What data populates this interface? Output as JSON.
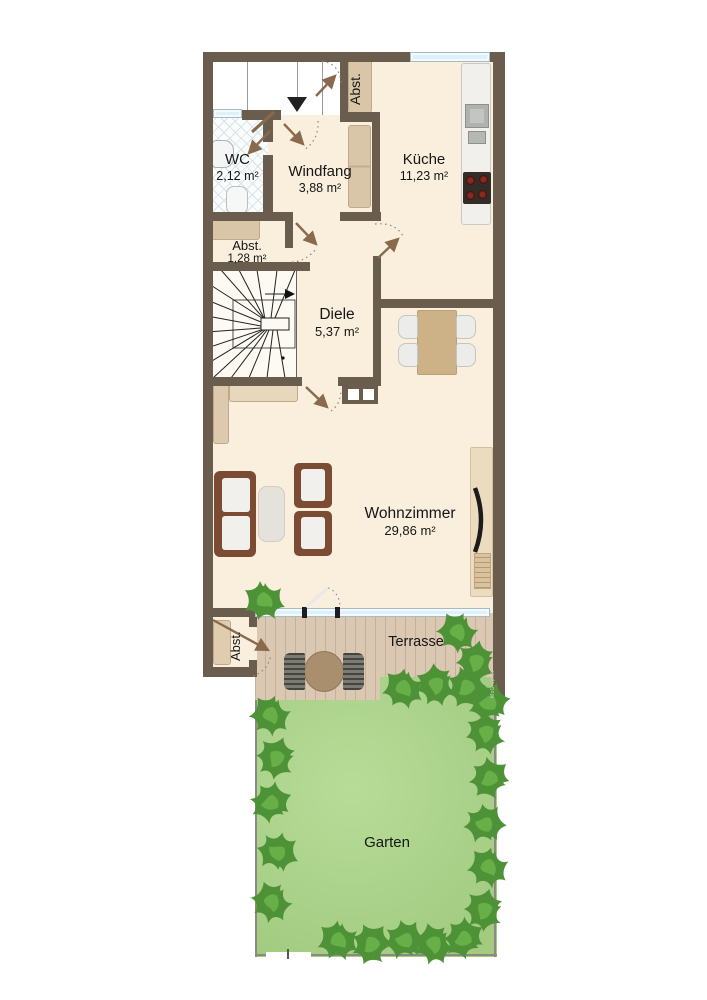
{
  "watermark": "MoGraphik",
  "rooms": {
    "wc": {
      "name": "WC",
      "area": "2,12 m²"
    },
    "windfang": {
      "name": "Windfang",
      "area": "3,88 m²"
    },
    "abst_top": {
      "name": "Abst."
    },
    "kueche": {
      "name": "Küche",
      "area": "11,23 m²"
    },
    "abst_mid": {
      "name": "Abst.",
      "area": "1,28 m²"
    },
    "diele": {
      "name": "Diele",
      "area": "5,37 m²"
    },
    "wohnzimmer": {
      "name": "Wohnzimmer",
      "area": "29,86 m²"
    },
    "abst_unten": {
      "name": "Abst."
    },
    "terrasse": {
      "name": "Terrasse"
    },
    "garten": {
      "name": "Garten"
    }
  },
  "colors": {
    "wall": "#6b5d4e",
    "floor": "#faeedd",
    "terrace": "#dbc8b2",
    "garden": "#abd687",
    "plant": "#4e9238",
    "window_glass": "#dff1f8",
    "arrow": "#8a6a4c",
    "stair": "#fdfaf3"
  }
}
